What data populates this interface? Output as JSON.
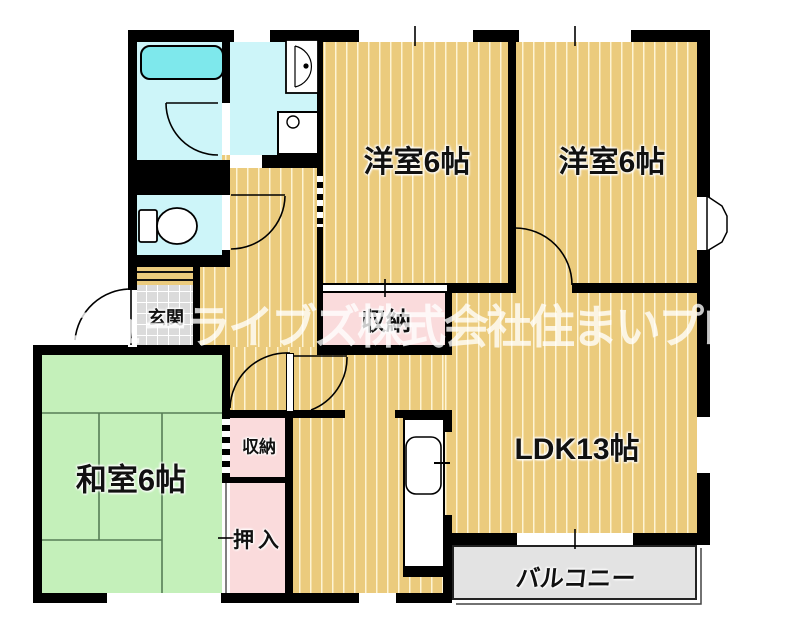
{
  "title": "floor-plan",
  "watermark": {
    "text": "ニューライブズ株式会社住まいプロ"
  },
  "rooms": {
    "yoshitsu_left": {
      "label": "洋室6帖"
    },
    "yoshitsu_right": {
      "label": "洋室6帖"
    },
    "washitsu": {
      "label": "和室6帖"
    },
    "ldk": {
      "label": "LDK13帖"
    },
    "genkan": {
      "label": "玄関"
    },
    "balcony": {
      "label": "バルコニー"
    },
    "closet_upper": {
      "label": "収納"
    },
    "closet_small": {
      "label": "収納"
    },
    "oshiire": {
      "label": "押入"
    }
  },
  "icons": [
    "bathtub-icon",
    "washbasin-icon",
    "washing-machine-icon",
    "toilet-icon",
    "kitchen-sink-icon",
    "bay-window",
    "door-swing-arc",
    "entry-step",
    "sliding-door-tick"
  ],
  "colors": {
    "floor_wood": "#EBCB7D",
    "floor_stripe": "#F6E7B8",
    "tatami_green": "#C4F0BA",
    "tatami_line": "#567D56",
    "closet_pink": "#FADBDC",
    "sanitary_cyan": "#CDF5F9",
    "bathtub_cyan": "#7EE8EC",
    "entry_tile": "#DBDBDB",
    "balcony_gray": "#E3E3E3",
    "wall_black": "#000000",
    "watermark_white": "rgba(255,255,255,0.78)"
  }
}
